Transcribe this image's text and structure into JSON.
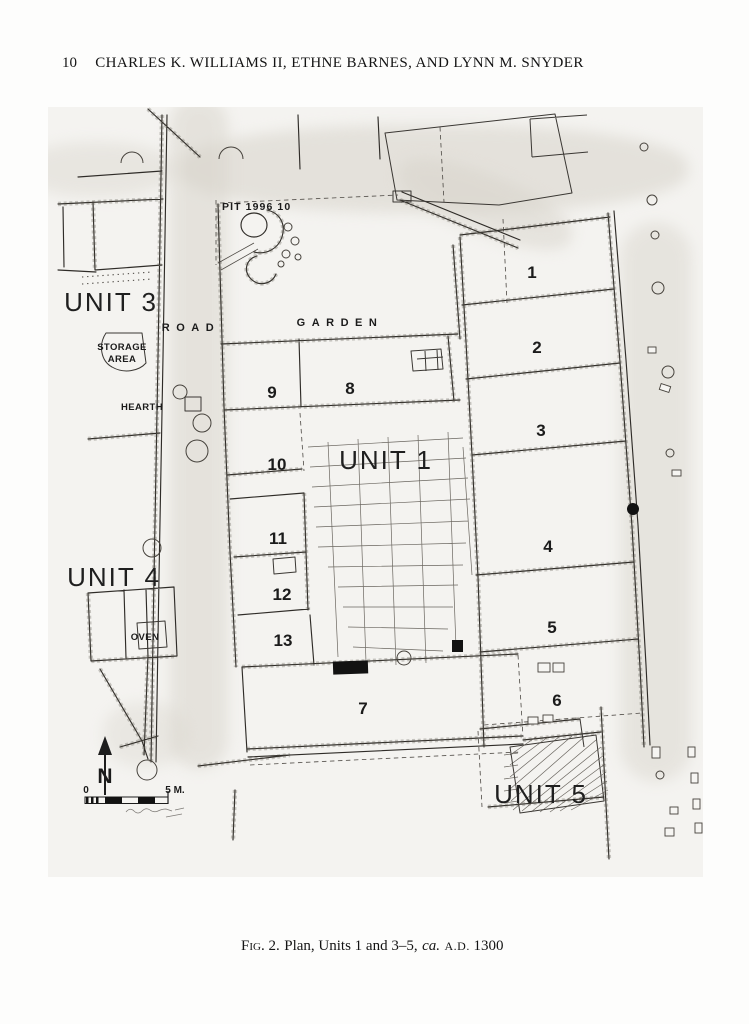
{
  "page": {
    "number": "10",
    "running_head": "CHARLES K. WILLIAMS II, ETHNE BARNES, AND LYNN M. SNYDER"
  },
  "figure": {
    "caption": {
      "fig_label": "Fig. 2.",
      "body": "Plan, Units 1 and 3–5,",
      "circa": "ca.",
      "era": "A.D.",
      "year": "1300"
    },
    "plan": {
      "unit_labels": [
        "UNIT 3",
        "UNIT 4",
        "UNIT 1",
        "UNIT 5"
      ],
      "room_numbers": [
        "1",
        "2",
        "3",
        "4",
        "5",
        "6",
        "7",
        "8",
        "9",
        "10",
        "11",
        "12",
        "13"
      ],
      "area_labels": {
        "road": "ROAD",
        "garden": "GARDEN",
        "storage_line1": "STORAGE",
        "storage_line2": "AREA",
        "hearth": "HEARTH",
        "oven": "OVEN",
        "pit": "PIT 1996 10"
      },
      "north_label": "N",
      "scale": {
        "start": "0",
        "end": "5 M."
      }
    }
  }
}
